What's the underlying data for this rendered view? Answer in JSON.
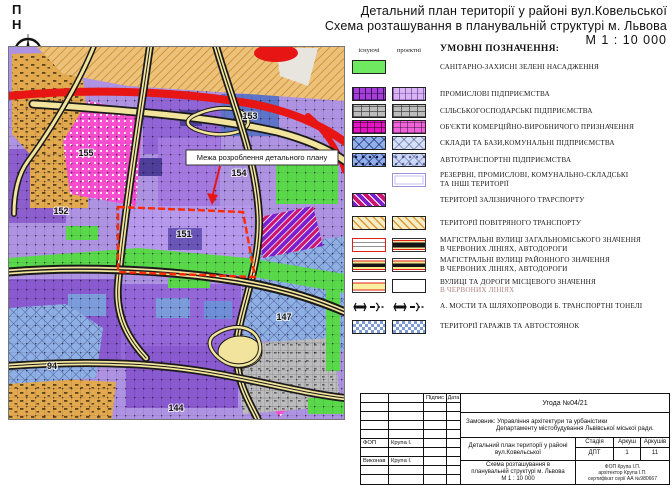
{
  "compass": {
    "label": "П Н"
  },
  "title": {
    "line1": "Детальний план території у районі вул.Ковельської",
    "line2": "Схема розташування в планувальній структурі м. Львова",
    "scale": "М  1 : 10 000"
  },
  "map": {
    "boundary_label": "Межа розроблення детального плану",
    "districts": [
      "153",
      "154",
      "155",
      "152",
      "151",
      "147",
      "144",
      "94"
    ]
  },
  "legend": {
    "heading": "УМОВНІ ПОЗНАЧЕННЯ:",
    "col_existing": "існуючі",
    "col_projected": "проектні",
    "items": [
      {
        "label": "САНІТАРНО-ЗАХИСНІ ЗЕЛЕНІ НАСАДЖЕННЯ"
      },
      {
        "label": "ПРОМИСЛОВІ ПІДПРИЄМСТВА"
      },
      {
        "label": "СІЛЬСЬКОГОСПОДАРСЬКІ ПІДПРИЄМСТВА"
      },
      {
        "label": "ОБ'ЄКТИ КОМЕРЦІЙНО-ВИРОБНИЧОГО ПРИЗНАЧЕННЯ"
      },
      {
        "label": "СКЛАДИ ТА БАЗИ,КОМУНАЛЬНІ ПІДПРИЄМСТВА"
      },
      {
        "label": "АВТОТРАНСПОРТНІ ПІДПРИЄМСТВА"
      },
      {
        "label": "РЕЗЕРВНІ, ПРОМИСЛОВІ, КОМУНАЛЬНО-СКЛАДСЬКІ",
        "label2": "ТА ІНШІ ТЕРИТОРІЇ"
      },
      {
        "label": "ТЕРИТОРІЇ ЗАЛІЗНИЧНОГО ТРАРСПОРТУ"
      },
      {
        "label": "ТЕРИТОРІЇ ПОВІТРЯНОГО ТРАНСПОРТУ"
      },
      {
        "label": "МАГІСТРАЛЬНІ ВУЛИЦІ ЗАГАЛЬНОМІСЬКОГО ЗНАЧЕННЯ",
        "label2": "В ЧЕРВОНИХ ЛІНІЯХ,  АВТОДОРОГИ"
      },
      {
        "label": "МАГІСТРАЛЬНІ ВУЛИЦІ РАЙОННОГО ЗНАЧЕННЯ",
        "label2": "В ЧЕРВОНИХ ЛІНІЯХ,  АВТОДОРОГИ"
      },
      {
        "label": "ВУЛИЦІ ТА ДОРОГИ МІСЦЕВОГО ЗНАЧЕННЯ",
        "label2": "В ЧЕРВОНИХ ЛІНІЯХ"
      },
      {
        "label": "А. МОСТИ ТА ШЛЯХОПРОВОДИ   Б. ТРАНСПОРТНІ ТОНЕЛІ"
      },
      {
        "label": "ТЕРИТОРІЇ ГАРАЖІВ ТА АВТОСТОЯНОК"
      }
    ]
  },
  "titleblock": {
    "col_signature": "Підпис",
    "col_date": "Дата",
    "agreement": "Угода №04/21",
    "client_line1": "Замовник: Управління архітектури та урбаністики",
    "client_line2": "Департаменту містобудування Львівської міської ради.",
    "rows": [
      {
        "role": "ФОП",
        "name": "Крупа І."
      },
      {
        "role": "Виконав",
        "name": "Крупа І."
      }
    ],
    "project_line1": "Детальний план території у районі",
    "project_line2": "вул.Ковельської",
    "stage_header": "Стадія",
    "sheet_header": "Аркуш",
    "sheets_header": "Аркушів",
    "stage": "ДПТ",
    "sheet": "1",
    "sheets": "11",
    "scheme_line1": "Схема розташування в",
    "scheme_line2": "планувальній структурі м. Львова",
    "scheme_line3": "М  1 : 10 000",
    "firm_line1": "ФОП Крупа І.П.",
    "firm_line2": "архітектор Крупа І.П.",
    "firm_line3": "сертифікат серії АА №980667"
  }
}
